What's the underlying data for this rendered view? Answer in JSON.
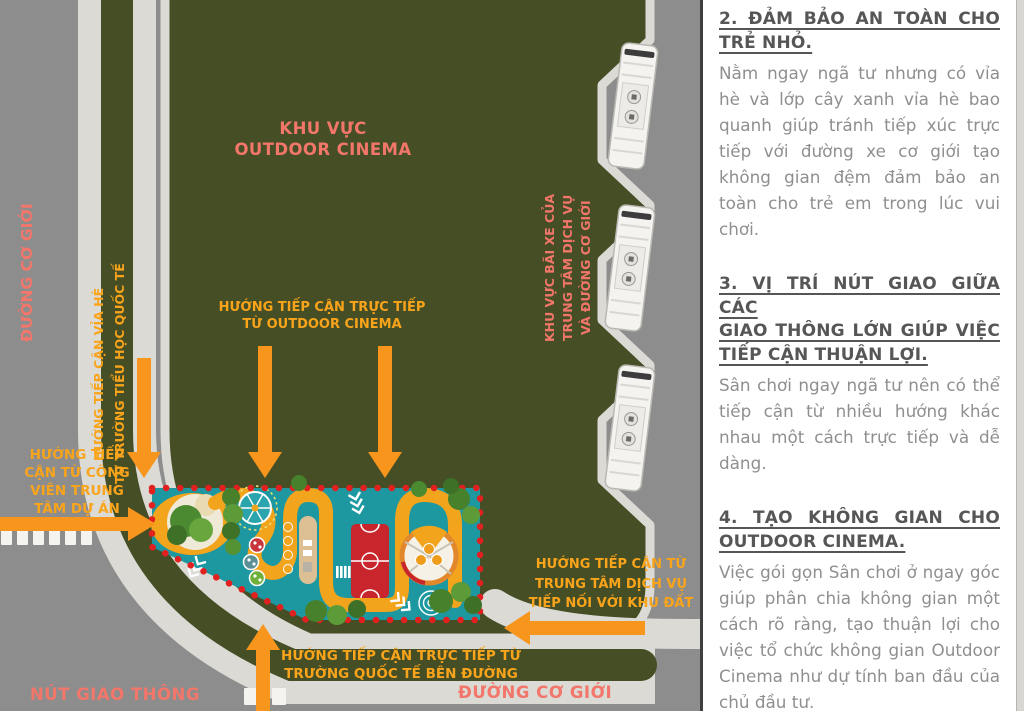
{
  "map": {
    "labels": {
      "zone": "KHU VỰC\nOUTDOOR CINEMA",
      "road_left": "ĐƯỜNG CƠ GIỚI",
      "sidewalk_access": "HƯỚNG TIẾP CẬN VỈA HÈ\nTỪ TRƯỜNG TIỂU HỌC QUỐC TẾ",
      "park_access": "HƯỚNG TIẾP\nCẬN TỪ CÔNG\nVIÊN TRUNG\nTÂM DỰ ÁN",
      "cinema_access": "HƯỚNG TIẾP CẬN TRỰC TIẾP\nTỪ OUTDOOR CINEMA",
      "parking_zone": "KHU VỰC BÃI XE CỦA\nTRUNG TÂM DỊCH VỤ\nVÀ ĐƯỜNG CƠ GIỚI",
      "service_access": "HƯỚNG TIẾP CẬN TỪ\nTRUNG TÂM DỊCH VỤ\nTIẾP NỐI VỚI KHU ĐẤT",
      "school_access": "HƯỚNG TIẾP CẬN TRỰC TIẾP TỪ\nTRƯỜNG QUỐC TẾ BÊN ĐƯỜNG",
      "intersection": "NÚT GIAO THÔNG",
      "road_bottom": "ĐƯỜNG CƠ GIỚI"
    },
    "icons": {
      "bus": "bus-top-view",
      "ferris_wheel": "ferris-wheel",
      "court": "sports-court",
      "spiral": "spiral-game",
      "chevron": "path-chevrons",
      "crosswalk": "zebra-crossing",
      "arrow": "access-arrow"
    },
    "colors": {
      "road_gray": "#8d8d8d",
      "sidewalk": "#dbdad4",
      "field_green": "#454e24",
      "playground_teal": "#1d98a1",
      "path_orange": "#f2a41d",
      "arrow_orange": "#f7951d",
      "court_red": "#c8252c",
      "border_dot_red": "#e32020",
      "coral_text": "#f3766b",
      "orange_text": "#f9a41b"
    }
  },
  "panel": {
    "sections": [
      {
        "heading_lines": [
          "2. ĐẢM BẢO AN TOÀN CHO",
          "TRẺ NHỎ."
        ],
        "body": "Nằm ngay ngã tư nhưng có vỉa hè và lớp cây xanh vỉa hè bao quanh giúp tránh tiếp xúc trực tiếp với đường xe cơ giới tạo không gian đệm đảm bảo an toàn cho trẻ em trong lúc vui chơi."
      },
      {
        "heading_lines": [
          "3. VỊ TRÍ NÚT GIAO GIỮA CÁC",
          "GIAO THÔNG LỚN GIÚP VIỆC",
          "TIẾP CẬN THUẬN LỢI."
        ],
        "body": "Sân chơi ngay ngã tư nên có thể tiếp cận từ nhiều hướng khác nhau một cách trực tiếp và dễ dàng."
      },
      {
        "heading_lines": [
          "4. TẠO KHÔNG GIAN CHO",
          "OUTDOOR CINEMA."
        ],
        "body": "Việc gói gọn Sân chơi ở ngay góc giúp phân chia không gian một cách rõ ràng, tạo thuận lợi cho việc tổ chức không gian Outdoor Cinema như dự tính ban đầu của chủ đầu tư."
      }
    ]
  }
}
